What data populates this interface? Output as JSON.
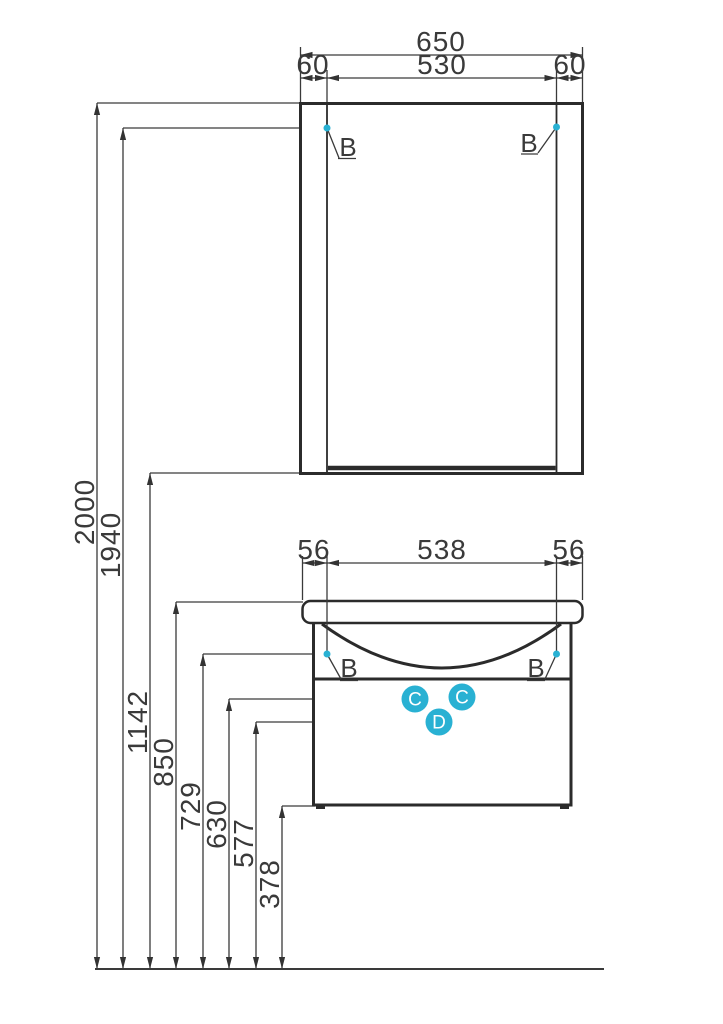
{
  "drawing": {
    "mirror": {
      "dim_total": "650",
      "dim_left": "60",
      "dim_center": "530",
      "dim_right": "60"
    },
    "vanity": {
      "dim_left": "56",
      "dim_center": "538",
      "dim_right": "56"
    },
    "heights": [
      "2000",
      "1940",
      "1142",
      "850",
      "729",
      "630",
      "577",
      "378"
    ],
    "callouts": {
      "mount": "B",
      "fitting_c": "C",
      "fitting_d": "D"
    },
    "colors": {
      "line": "#333333",
      "accent": "#29b1d3"
    }
  }
}
